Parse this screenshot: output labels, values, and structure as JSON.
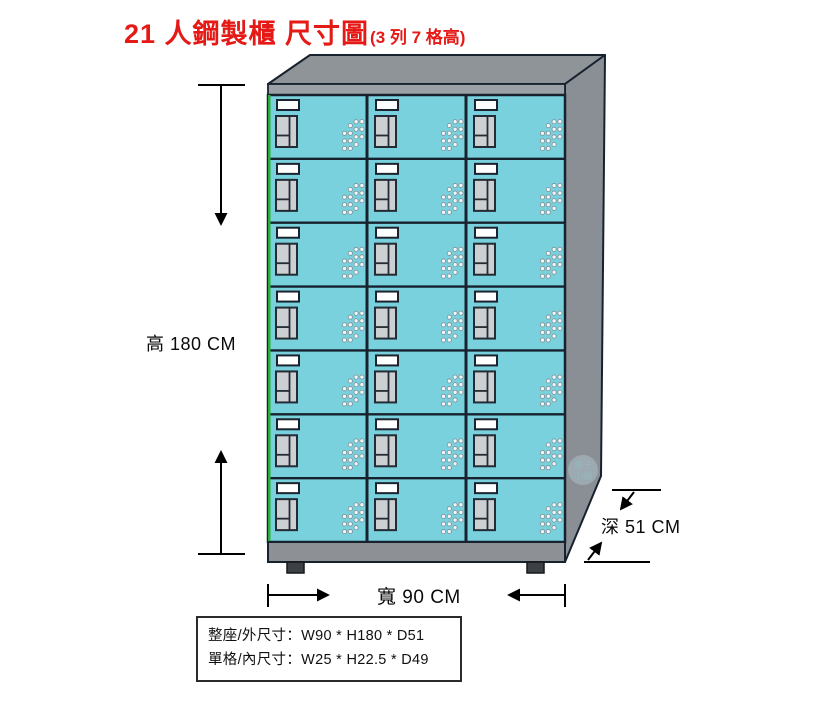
{
  "title": {
    "main": "21 人鋼製櫃 尺寸圖",
    "sub": "(3 列 7 格高)"
  },
  "dimensions": {
    "height": "高 180 CM",
    "width": "寬 90 CM",
    "depth": "深 51 CM"
  },
  "spec_box": {
    "line1": "整座/外尺寸：W90 * H180 * D51",
    "line2": "單格/內尺寸：W25 * H22.5 * D49"
  },
  "locker": {
    "rows": 7,
    "columns": 3,
    "total_cells": 21
  },
  "watermark": {
    "line1": "格子",
    "line2": "小舖"
  },
  "colors": {
    "title_red": "#e51a17",
    "door_cyan": "#79d1de",
    "frame_dark": "#18222e",
    "roof_gray": "#8f9499",
    "side_gray": "#8a8f95",
    "header_gray": "#9ba1a6",
    "base_gray": "#8d9196",
    "foot_dark": "#3d4145",
    "lock_gray": "#ccd0d3",
    "accent_green": "#2fae3e"
  }
}
